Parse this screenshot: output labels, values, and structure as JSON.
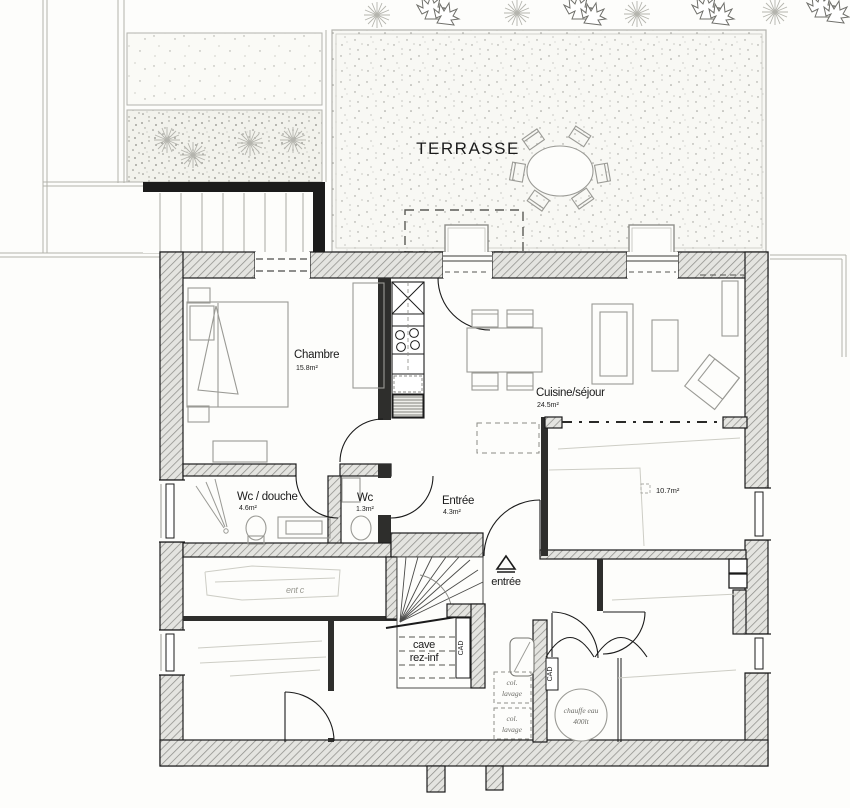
{
  "plan": {
    "terrace_label": "TERRASSE",
    "rooms": {
      "chambre": {
        "name": "Chambre",
        "area": "15.8m²"
      },
      "cuisine_sejour": {
        "name": "Cuisine/séjour",
        "area": "24.5m²"
      },
      "wc_douche": {
        "name": "Wc / douche",
        "area": "4.6m²"
      },
      "wc": {
        "name": "Wc",
        "area": "1.3m²"
      },
      "entree": {
        "name": "Entrée",
        "area": "4.3m²"
      },
      "piece_10_7": {
        "area": "10.7m²"
      }
    },
    "annotations": {
      "entrance_arrow_label": "entrée",
      "stair_label_line1": "cave",
      "stair_label_line2": "rez-inf",
      "radiator_label": "CAD",
      "laundry_column_line1": "col.",
      "laundry_column_line2": "lavage",
      "water_heater_line1": "chauffe eau",
      "water_heater_line2": "400lt",
      "faint_pencil_note": "ent c"
    },
    "colors": {
      "paper": "#fdfdfb",
      "ink": "#1b1b1b",
      "wall_fill": "#e4e4e0",
      "hatch_line": "#8e8e8a",
      "furniture": "#9a9a95",
      "pencil": "#cdcdc5",
      "stipple": "#9a9a94"
    }
  }
}
